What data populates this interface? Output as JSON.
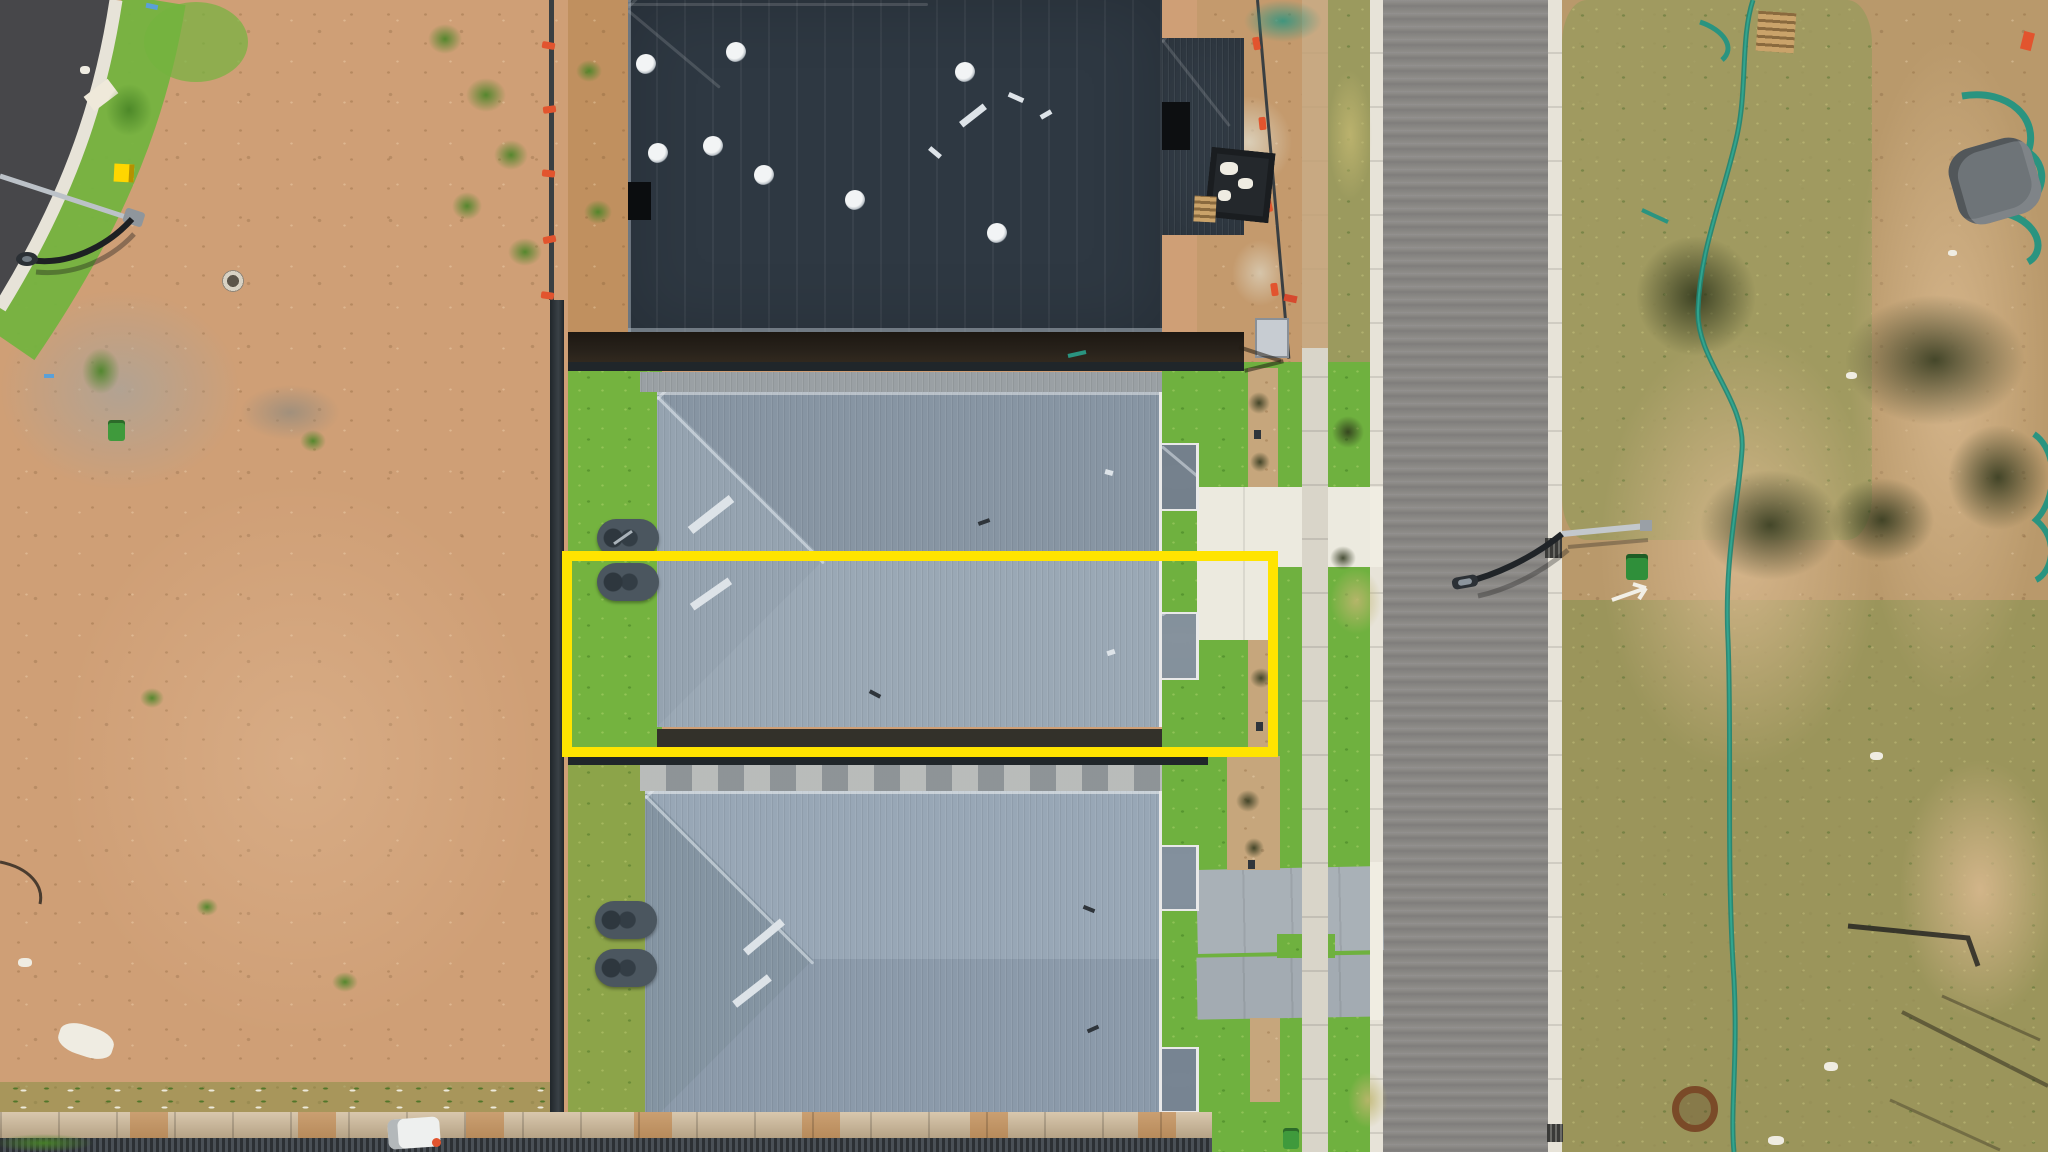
{
  "scene": {
    "type": "aerial-drone-photo",
    "description": "Top-down drone photograph of a new residential subdivision: a vacant dirt lot and curved street corner on the left, three dark-roofed dwellings in a vertical row in the centre, a new asphalt street with concrete kerbs, footpath and nature strip on the right, and cleared scrub land with a green silt fence on the far right. A yellow rectangle outlines the middle duplex dwelling and its yard."
  },
  "annotation": {
    "highlight_color": "#ffe400",
    "highlighted_lot": "middle duplex dwelling and rear yard outlined in yellow"
  },
  "palette": {
    "dirt_left": "#cf9f76",
    "dirt_shade": "#b9854f",
    "dirt_right": "#b9996b",
    "sand_light": "#d8b88e",
    "asphalt_dark": "#47474a",
    "asphalt_light": "#8a8885",
    "asphalt_light2": "#7c7a77",
    "curb": "#e7e3d8",
    "footpath": "#d9d5c9",
    "driveway_white": "#eceadf",
    "driveway_gray": "#a9b1b7",
    "grass_bright": "#74b33f",
    "grass_verge": "#6fb13f",
    "grass_olive": "#9b9a5e",
    "lawn_olive": "#8ca449",
    "grass_dark": "#4e7d2e",
    "roof_dark": "#2e3842",
    "roof_dark_hi": "#46505b",
    "roof_mid_n": "#8795a3",
    "roof_mid_s": "#9aa8b5",
    "roof_mid_w": "#95a3b0",
    "roof_bot_n": "#98a7b6",
    "roof_bot_s": "#8b9aaa",
    "roof_bot_w": "#8494a2",
    "ridge_light": "#c8cfd6",
    "gutter_white": "#e9e9e9",
    "tank_dark": "#4b565f",
    "fence_dark": "#20262a",
    "gravel": "#9aa0a4",
    "mulch": "#c6a67c",
    "stone_wall": "#ccb592",
    "rust": "#b97c3c",
    "corrugated": "#2c3034",
    "highlight_yellow": "#ffe400",
    "teal_mesh": "#2a9480",
    "safety_orange": "#e2542e",
    "bin_green": "#3f9a3c",
    "shadow_band": "#27211a",
    "pole_silver": "#bcc2c8",
    "lamp_dark": "#1d2023"
  },
  "landmarks": {
    "highlighted_lot": "middle duplex dwelling outlined in yellow",
    "top_house": "house under construction with dark charcoal hip roof",
    "middle_house": "completed duplex with light grey metal roof",
    "bottom_house": "completed duplex with blue-grey metal roof",
    "left_area": "cleared vacant dirt lot beside a curved street corner",
    "right_area": "uncleared scrub with temporary silt fencing",
    "road": "new asphalt street with concrete kerbs and footpath",
    "street_lights": "two street light poles with curved arms",
    "water_tanks": "slimline rainwater tanks beside each dwelling",
    "bins": "green wheelie bins",
    "construction_items": "skip crate, pallets, mesh fencing and tarps"
  }
}
